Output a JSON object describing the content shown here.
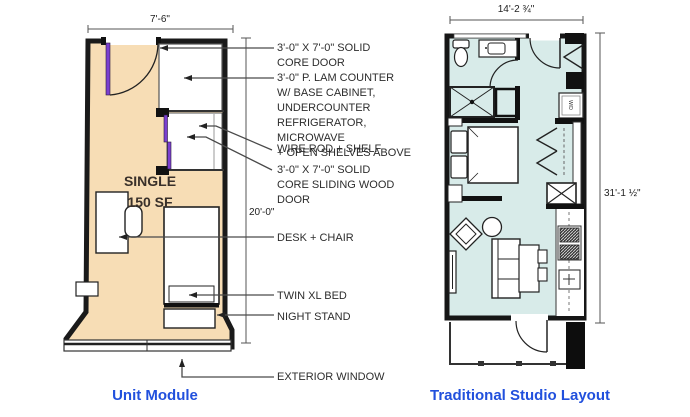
{
  "left_plan": {
    "caption": "Unit Module",
    "room_label": "SINGLE\n150 SF",
    "dim_width": "7'-6\"",
    "dim_height": "20'-0\"",
    "annotations": {
      "door": "3'-0\" X 7'-0\" SOLID\nCORE DOOR",
      "counter": "3'-0\" P. LAM COUNTER\nW/ BASE CABINET,\nUNDERCOUNTER\nREFRIGERATOR, MICROWAVE\n+ OPEN SHELVES ABOVE",
      "wire_rod": "WIRE ROD + SHELF",
      "sliding_door": "3'-0\" X 7'-0\" SOLID\nCORE SLIDING WOOD\nDOOR",
      "desk": "DESK + CHAIR",
      "bed": "TWIN XL BED",
      "night_stand": "NIGHT STAND",
      "window": "EXTERIOR WINDOW"
    }
  },
  "right_plan": {
    "caption": "Traditional Studio Layout",
    "dim_width": "14'-2 ¾\"",
    "dim_height": "31'-1 ½\"",
    "appliance_label": "W/D"
  },
  "colors": {
    "unit_floor": "#f7ddb5",
    "studio_floor": "#d8ebe9",
    "accent_purple": "#7b3fd0",
    "caption_blue": "#2150dd",
    "wall_black": "#1a1a1a"
  }
}
